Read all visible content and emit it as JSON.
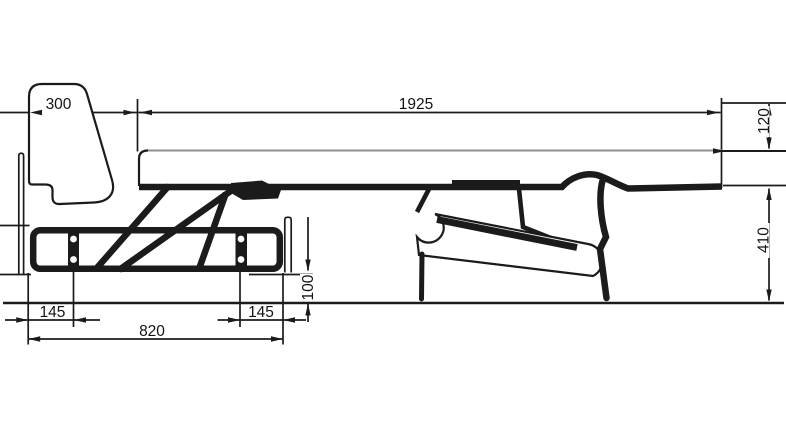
{
  "figure": {
    "dimensions": {
      "backrest_depth": "300",
      "sleeping_length": "1925",
      "mattress_thickness": "120",
      "bed_height": "410",
      "base_inset_left": "145",
      "base_inset_right": "145",
      "base_length": "820",
      "base_ground_clearance": "100"
    },
    "colors": {
      "ink": "#1b1b1b",
      "mattress_top_line": "#8f8f8f",
      "background": "#ffffff"
    }
  }
}
